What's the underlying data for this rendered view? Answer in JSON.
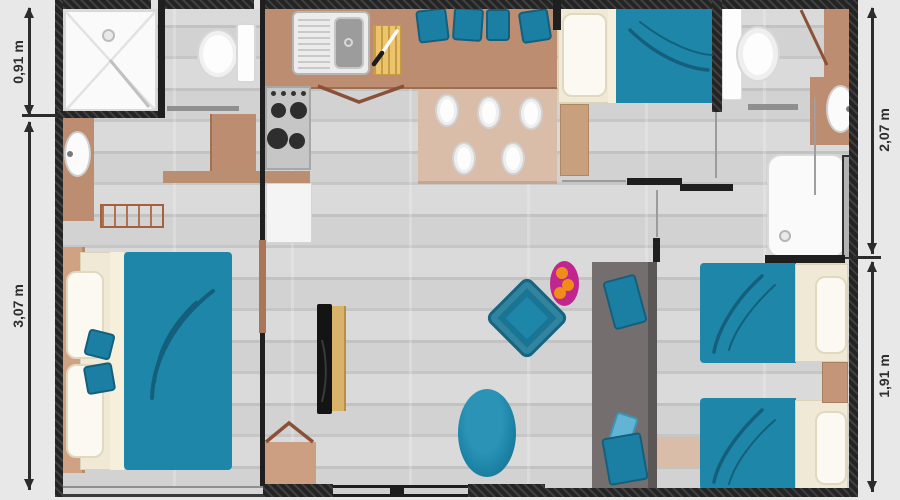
{
  "page": {
    "type": "floor-plan",
    "background_color": "#e8e8e8"
  },
  "dimensions": {
    "left_top": {
      "label": "0,91 m"
    },
    "left_bottom": {
      "label": "3,07 m"
    },
    "right_top": {
      "label": "2,07 m"
    },
    "right_bottom": {
      "label": "1,91 m"
    }
  },
  "colors": {
    "wall": "#242424",
    "floor": "#cbcbcb",
    "accent_teal": "#1e86a9",
    "teal_dark": "#14607c",
    "wood_tan": "#bd8d72",
    "light_tan": "#d9bda8",
    "cream": "#f0e9d6",
    "sofa_gray": "#746f6e",
    "magenta_plate": "#c1268e",
    "orange_fruit": "#ef8c1a",
    "dimension_text": "#2e2e2e"
  },
  "furniture_icons": [
    "shower-tray-icon",
    "toilet-icon",
    "washbasin-icon",
    "towel-rail-icon",
    "kitchen-sink-icon",
    "cutting-board-icon",
    "knife-icon",
    "stove-icon",
    "dining-bench-icon",
    "seat-cushion-icon",
    "dining-table-icon",
    "plate-icon",
    "double-bed-icon",
    "single-bed-icon",
    "pillow-icon",
    "throw-cushion-icon",
    "tv-icon",
    "tv-stand-icon",
    "cabinet-icon",
    "fridge-icon",
    "dresser-icon",
    "floor-pouf-icon",
    "fruit-plate-icon",
    "sofa-icon",
    "nightstand-icon",
    "rug-icon",
    "shower-door-icon",
    "door-swing-icon",
    "sliding-door-icon",
    "window-icon"
  ]
}
